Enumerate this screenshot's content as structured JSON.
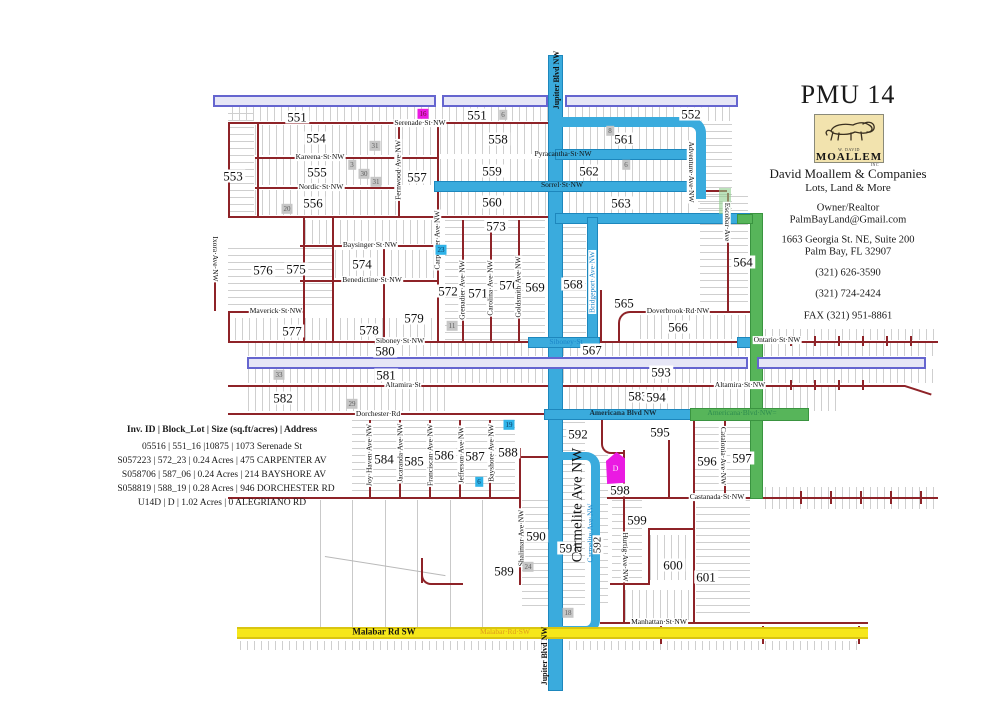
{
  "title": "PMU 14",
  "contact": {
    "logo_top": "W. DAVID",
    "logo_word": "MOALLEM",
    "logo_inc": "INC",
    "company": "David Moallem & Companies",
    "tagline": "Lots, Land & More",
    "role": "Owner/Realtor",
    "email": "PalmBayLand@Gmail.com",
    "addr1": "1663 Georgia St. NE, Suite 200",
    "addr2": "Palm Bay, FL   32907",
    "phone1": "(321) 626-3590",
    "phone2": "(321) 724-2424",
    "fax": "FAX (321) 951-8861"
  },
  "legend": {
    "header": "Inv. ID | Block_Lot | Size (sq.ft/acres) | Address",
    "rows": [
      "05516 |  551_16  |10875   |  1073 Serenade St",
      "S057223 | 572_23 | 0.24 Acres | 475 CARPENTER AV",
      "S058706 | 587_06 | 0.24 Acres | 214 BAYSHORE AV",
      "S058819 | 588_19 | 0.28 Acres | 946 DORCHESTER RD",
      "U14D | D |   1.02 Acres   | 0 ALEGRIANO RD"
    ]
  },
  "map": {
    "colors": {
      "road_red": "#8e2328",
      "route_blue": "#3aabdd",
      "route_green": "#57b55a",
      "bar_lavender": "#e6e6f6",
      "bar_lavender_border": "#6565cf",
      "bar_yellow": "#f6e719",
      "highlight_magenta": "#ea1ae2",
      "highlight_cyan": "#2fb3e8",
      "label_orange": "#e09b1e"
    },
    "parcelD": "D",
    "blocks": {
      "b551a": "551",
      "b551b": "551",
      "b552": "552",
      "b553": "553",
      "b554": "554",
      "b555": "555",
      "b556": "556",
      "b557": "557",
      "b558": "558",
      "b559": "559",
      "b560": "560",
      "b561": "561",
      "b562": "562",
      "b563": "563",
      "b564": "564",
      "b565": "565",
      "b566": "566",
      "b567": "567",
      "b568": "568",
      "b569": "569",
      "b570": "570",
      "b571": "571",
      "b572": "572",
      "b573": "573",
      "b574": "574",
      "b575": "575",
      "b576": "576",
      "b577": "577",
      "b578": "578",
      "b579": "579",
      "b580": "580",
      "b581": "581",
      "b582": "582",
      "b583": "583",
      "b584": "584",
      "b585": "585",
      "b586": "586",
      "b587": "587",
      "b588": "588",
      "b589": "589",
      "b590": "590",
      "b591": "591",
      "b592a": "592",
      "b592b": "592",
      "b593": "593",
      "b594": "594",
      "b595": "595",
      "b596": "596",
      "b597": "597",
      "b598": "598",
      "b599": "599",
      "b600": "600",
      "b601": "601"
    },
    "streets": {
      "serenade": "Serenade·St·NW",
      "kareena": "Kareena·St·NW",
      "nordic": "Nordic·St·NW",
      "pyracantha": "Pyracantha·St·NW",
      "sorrel": "Sorrel·St·NW",
      "baysinger": "Baysinger·St·NW",
      "benedictine": "Benedictine·St·NW",
      "maverick": "Maverick·St·NW",
      "siboney": "Siboney·St·NW",
      "siboney_blue": "Siboney·St",
      "doverbrook": "Doverbrook·Rd·NW",
      "ontario": "Ontario·St·NW",
      "altamira": "Altamira·St",
      "altamira_nw": "Altamira·St·NW",
      "dorchester": "Dorchester·Rd",
      "americana": "Americana Blvd NW",
      "americana_green": "Americana·Blvd·NW=",
      "castanada": "Castanada·St·NW",
      "manhattan": "Manhattan·St·NW",
      "malabar_black": "Malabar Rd SW",
      "malabar_orange": "Malabar·Rd·SW",
      "jupiter": "Jupiter Blvd NW",
      "fernwood": "Fernwood·Ave·NW",
      "carpenter": "Carpenter·Ave·NW",
      "adventure": "Adventure·Ave·NW",
      "escobar": "Escobar·Ave",
      "bridgeport": "Bridgeport·Ave·NW",
      "grenadier": "Grenadier·Ave·NW",
      "carolina": "Carolina·Ave·NW",
      "goldsmith": "Goldsmith·Ave·NW",
      "ixora": "Ixora·Ave·NW",
      "joyhaven": "Joy·Haven·Ave·NW",
      "jacaranda": "Jacaranda·Ave·NW",
      "franciscan": "Franciscan·Ave·NW",
      "jefferson": "Jefferson·Ave·NW",
      "bayshore": "Bayshore·Ave·NW",
      "shalimar": "Shalimar·Ave·NW",
      "hurtig": "Hurtig·Ave·NW",
      "catalonia": "Catalonia·Ave·NW",
      "carmelite_big": "Carmelite Ave NW",
      "carmelite_small": "Carmelite·Ave·NW"
    },
    "badges": {
      "m16": "16",
      "g6a": "6",
      "g31a": "31",
      "g3": "3",
      "g30": "30",
      "g31b": "31",
      "g20": "20",
      "g8": "8",
      "g6b": "6",
      "c23": "23",
      "g11": "11",
      "g33": "33",
      "g29": "29",
      "c19": "19",
      "c6": "6",
      "g24": "24",
      "g18": "18"
    }
  }
}
